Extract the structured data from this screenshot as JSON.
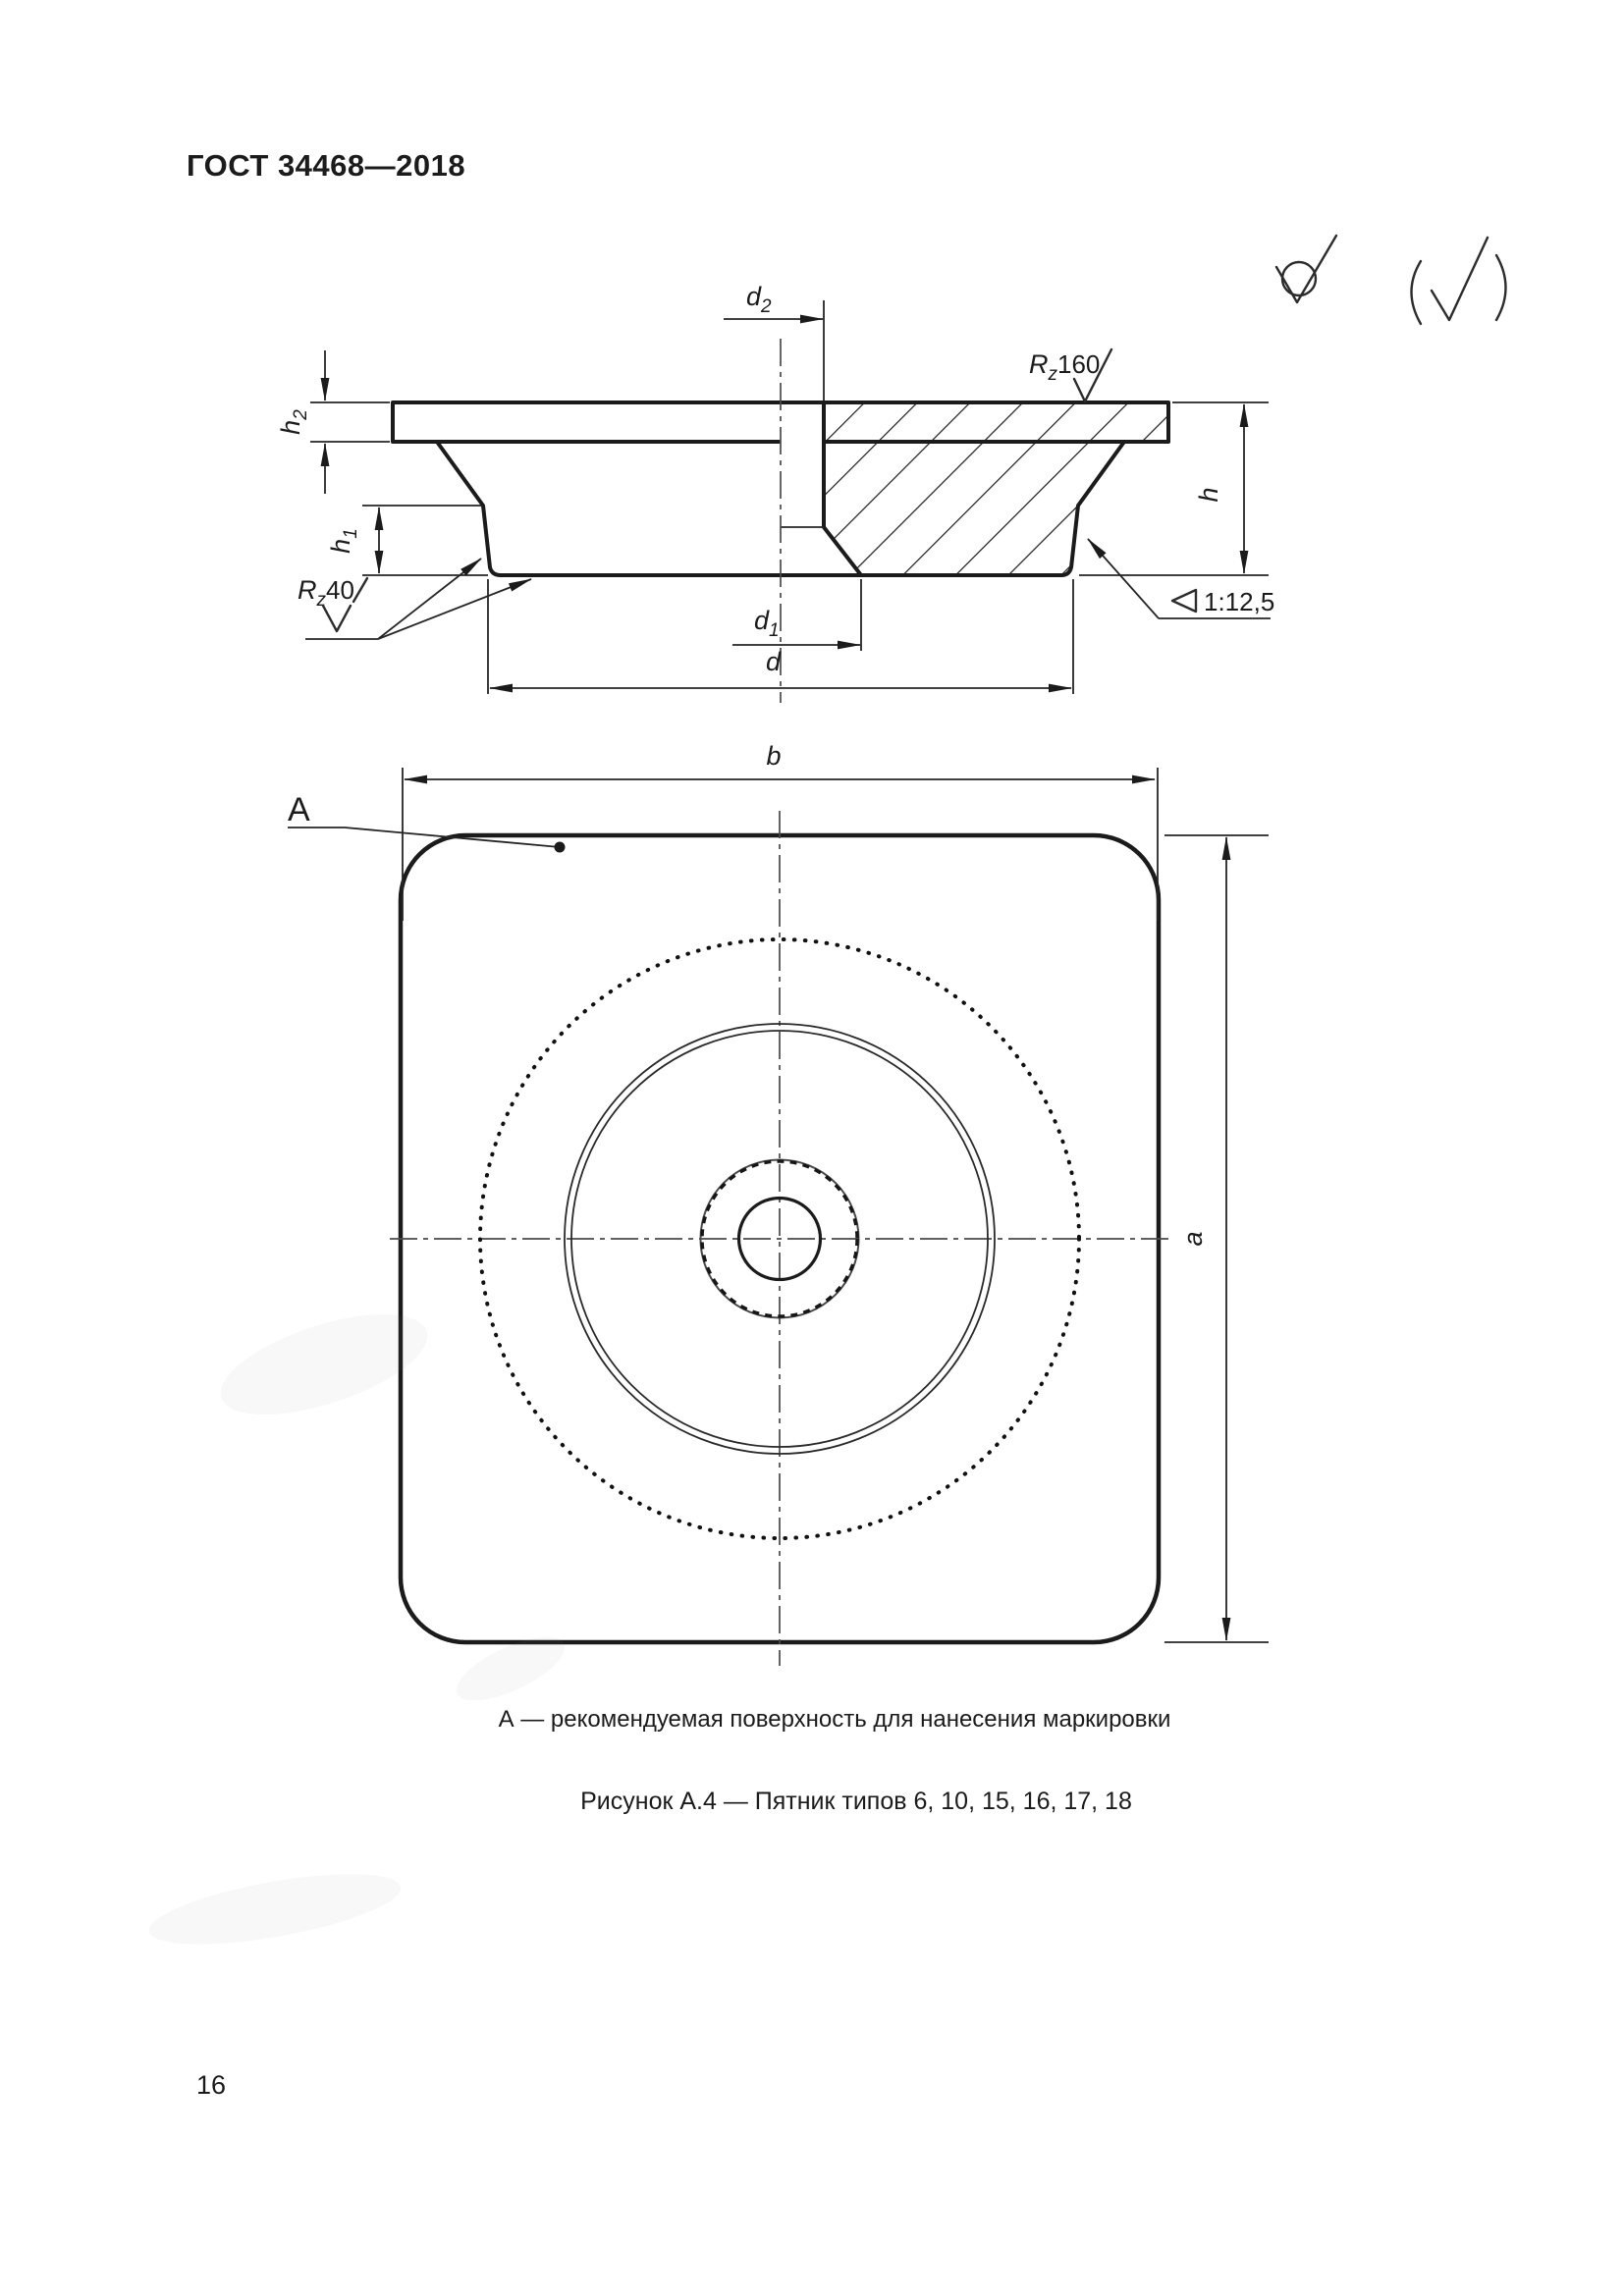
{
  "page": {
    "header": "ГОСТ 34468—2018",
    "page_number": "16"
  },
  "corner_marks": {
    "roughness_all_icon": "roughness-check-circle-icon",
    "roughness_bracket_icon": "paren-roughness-check-icon"
  },
  "section_view": {
    "labels": {
      "d2": {
        "base": "d",
        "sub": "2"
      },
      "d1": {
        "base": "d",
        "sub": "1"
      },
      "d": {
        "base": "d"
      },
      "h": {
        "base": "h"
      },
      "h1": {
        "base": "h",
        "sub": "1"
      },
      "h2": {
        "base": "h",
        "sub": "2"
      },
      "rz160": {
        "base": "R",
        "sub": "z",
        "value": "160"
      },
      "rz40": {
        "base": "R",
        "sub": "z",
        "value": "40"
      },
      "taper": "1:12,5"
    }
  },
  "plan_view": {
    "labels": {
      "b": {
        "base": "b"
      },
      "a": {
        "base": "a"
      },
      "marker": "А"
    }
  },
  "captions": {
    "surface_note": "А — рекомендуемая поверхность для нанесения маркировки",
    "figure_caption": "Рисунок А.4 — Пятник типов 6, 10, 15, 16, 17, 18"
  }
}
